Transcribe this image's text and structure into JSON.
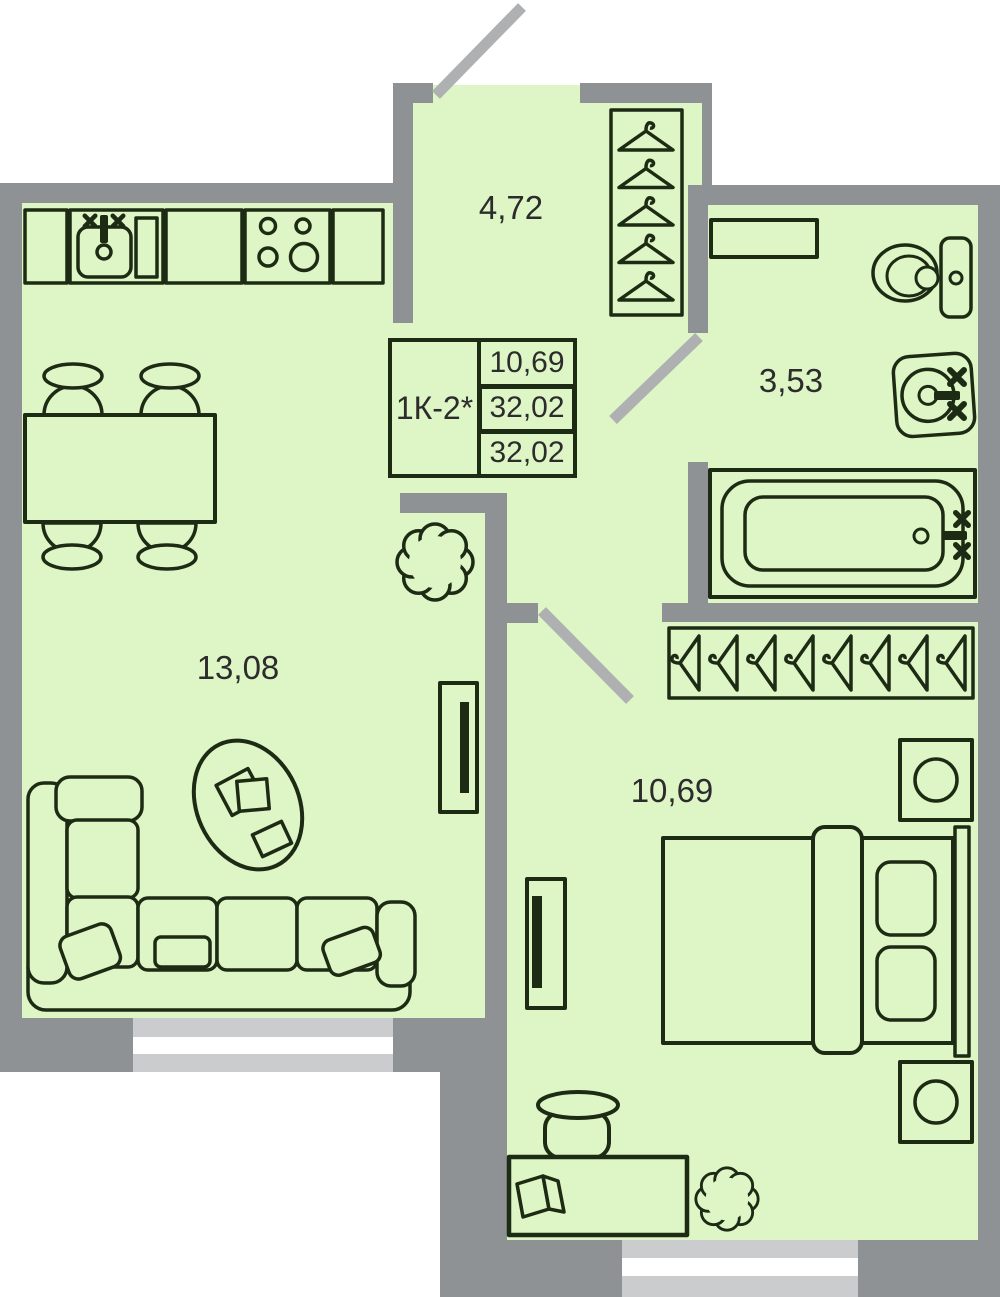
{
  "title": "Apartment floor plan 1K",
  "rooms": {
    "hallway": {
      "area": "4,72"
    },
    "bathroom": {
      "area": "3,53"
    },
    "living_kitchen": {
      "area": "13,08"
    },
    "bedroom": {
      "area": "10,69"
    }
  },
  "info_box": {
    "unit_type": "1К-2*",
    "rows": [
      "10,69",
      "32,02",
      "32,02"
    ]
  },
  "colors": {
    "wall": "#8f9294",
    "door_leaf": "#aeb0b2",
    "window_band": "#caccce",
    "window_pane": "#ffffff",
    "floor": "#def5c6",
    "outline_ink": "#1d2b14",
    "label_text": "#2c2c2c"
  },
  "icons": [
    "kitchen-counter-icon",
    "kitchen-sink-icon",
    "stove-icon",
    "dining-table-icon",
    "chair-icon",
    "corner-sofa-icon",
    "throw-pillow-icon",
    "coffee-table-icon",
    "tv-icon",
    "plant-icon",
    "coat-hanger-icon",
    "closet-icon",
    "wardrobe-icon",
    "toilet-icon",
    "washbasin-icon",
    "bathtub-icon",
    "shelf-icon",
    "double-bed-icon",
    "pillow-icon",
    "nightstand-icon",
    "desk-icon",
    "desk-chair-icon",
    "book-icon",
    "door-leaf-icon",
    "window-icon"
  ]
}
